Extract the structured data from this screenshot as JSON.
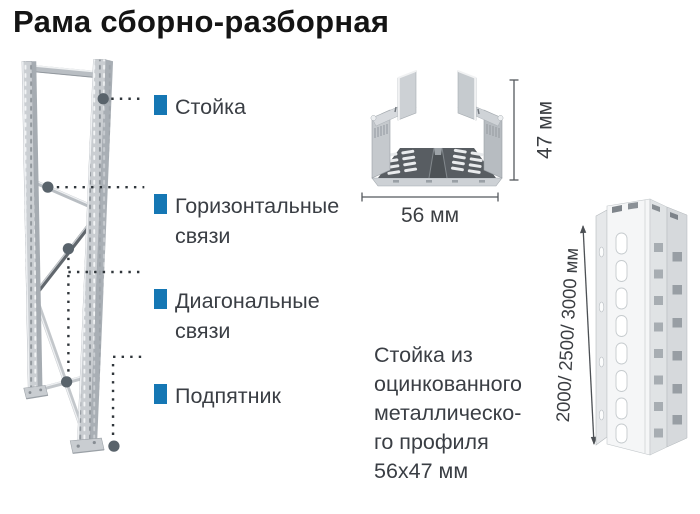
{
  "title": "Рама сборно-разборная",
  "colors": {
    "accent": "#1577b4",
    "text": "#3a3e44",
    "title": "#141414",
    "metal_light": "#c9cdd1",
    "metal_dark": "#5a5f64"
  },
  "callouts": [
    {
      "line1": "Стойка",
      "line2": ""
    },
    {
      "line1": "Горизонтальные",
      "line2": "связи"
    },
    {
      "line1": "Диагональные",
      "line2": "связи"
    },
    {
      "line1": "Подпятник",
      "line2": ""
    }
  ],
  "cross_section": {
    "width_label": "56 мм",
    "height_label": "47 мм"
  },
  "upright_profile": {
    "length_label": "2000/ 2500/ 3000 мм"
  },
  "description": {
    "lines": [
      "Стойка из",
      "оцинкованного",
      "металлическо-",
      "го профиля",
      "56х47 мм"
    ]
  }
}
